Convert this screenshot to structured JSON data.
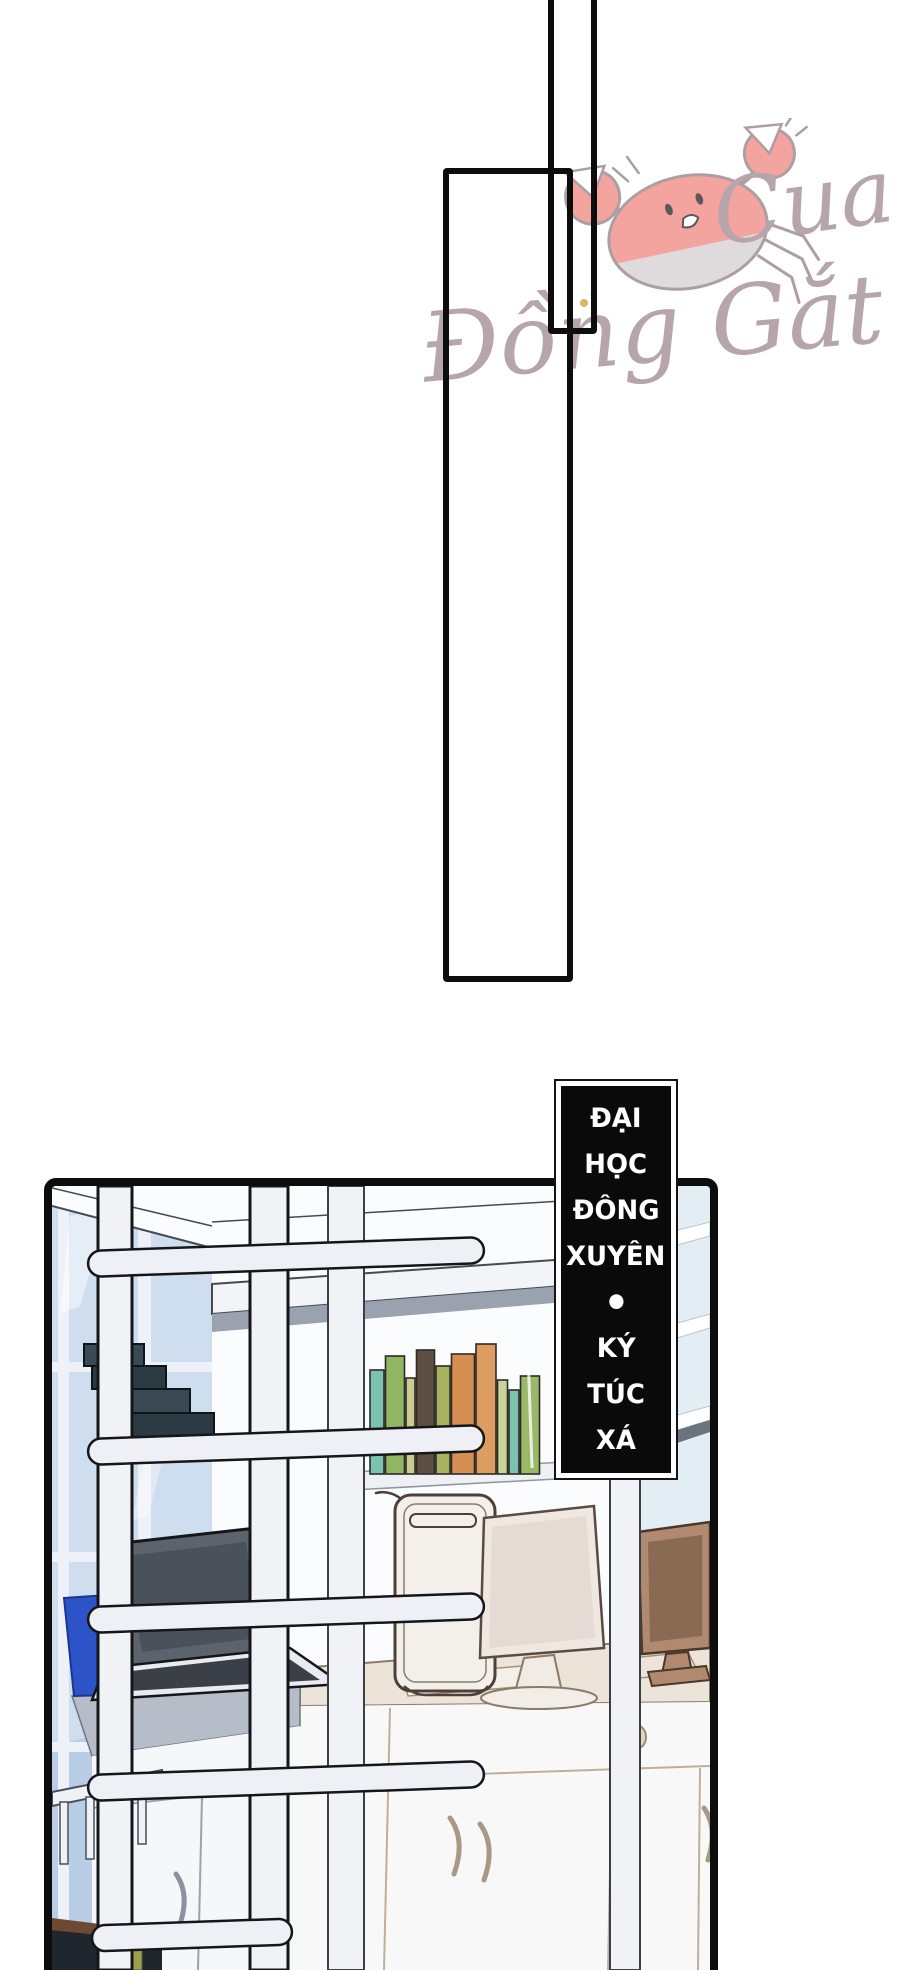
{
  "watermark": {
    "artist_line1": "Cua",
    "artist_line2": "Đồng Gắt"
  },
  "caption_box": {
    "full_text": "ĐẠI HỌC ĐÔNG XUYÊN • KÝ TÚC XÁ",
    "lines": [
      "ĐẠI",
      "HỌC",
      "ĐÔNG",
      "XUYÊN",
      "•",
      "KÝ",
      "TÚC",
      "XÁ"
    ]
  },
  "scene": {
    "bookshelf_books": [
      {
        "color": "#7cc2b1",
        "width": 14,
        "height": 104
      },
      {
        "color": "#8fb763",
        "width": 19,
        "height": 118
      },
      {
        "color": "#c9cc8e",
        "width": 9,
        "height": 96
      },
      {
        "color": "#5d5043",
        "width": 18,
        "height": 124
      },
      {
        "color": "#a9b25e",
        "width": 14,
        "height": 108
      },
      {
        "color": "#d68f51",
        "width": 23,
        "height": 120
      },
      {
        "color": "#dd9c60",
        "width": 20,
        "height": 130
      },
      {
        "color": "#ccd39a",
        "width": 10,
        "height": 94
      },
      {
        "color": "#7cc2b1",
        "width": 10,
        "height": 84
      },
      {
        "color": "#99b868",
        "width": 19,
        "height": 98
      }
    ]
  },
  "theme": {
    "panel_line": "#0d0d0d",
    "caption_bg": "#0a0a0a",
    "caption_fg": "#ffffff",
    "caption_border": "#ffffff",
    "wm_text": "#a8929b",
    "crab_body": "#f2918b",
    "crab_belly": "#d8d4d5",
    "crab_line": "#9b8a90",
    "sparkle": "#d4a93c",
    "window_glass": "#cfdeef",
    "window_glass_dark": "#b9cde6",
    "mullion": "#eef2f8",
    "wall": "#fbfcfd",
    "shelf_shadow": "#99a2ae",
    "frame_white": "#f0f2f6",
    "frame_line": "#15161a",
    "struct_line": "#454b55",
    "dark_book_a": "#3a4a54",
    "dark_book_b": "#2c3a44",
    "dark_book_c": "#46392f",
    "laptop_screen": "#5c636c",
    "laptop_dark": "#3b4048",
    "laptop_base": "#e9ebf0",
    "blue_bin": "#2c54c8",
    "desk_top": "#ece4d8",
    "desk_line": "#8b7b6b",
    "cabinet_line": "#bfae9a",
    "knob": "#e3d3c0",
    "tower": "#f3f0ec",
    "tower_line": "#4e4038",
    "monitor_body": "#efe8e1",
    "monitor_screen": "#e5dbd4",
    "rmonitor": "#b1896f",
    "rmonitor_dark": "#4a382c",
    "rmonitor_screen": "#8a6a52",
    "glass_right": "#e3edf4",
    "gray_desk": "#b6bdc8",
    "dark_corner": "#20262e",
    "brown_strip": "#6f4a33",
    "green_bit": "#9aa04e"
  }
}
